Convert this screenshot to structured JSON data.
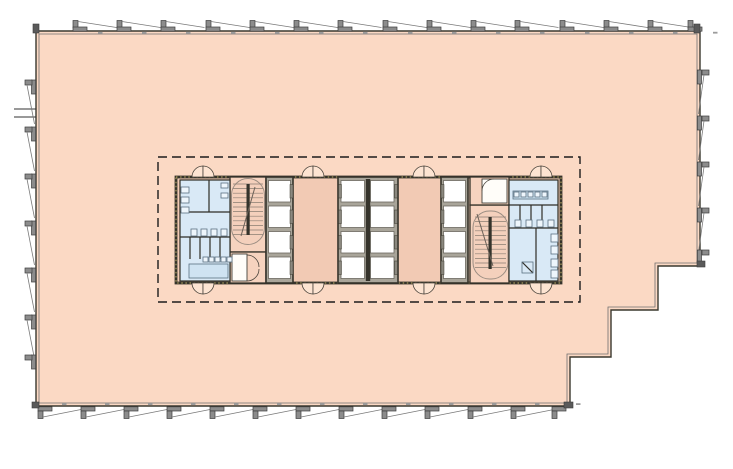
{
  "page": {
    "title": "Office floor plan",
    "background": "#ffffff"
  },
  "watermark": {
    "text_line1": "OFFICE",
    "text_line2": "NAVIGATOR",
    "color": "#ffffff",
    "opacity": 0.55,
    "font_size": 26,
    "letter_spacing": 3.5,
    "blocks": [
      {
        "lines": [
          {
            "text": "OFFICE",
            "x": 50,
            "y": 120
          },
          {
            "text": "NAVIGATOR",
            "x": 50,
            "y": 152
          }
        ]
      },
      {
        "lines": [
          {
            "text": "OFFICE",
            "x": 281,
            "y": 233
          },
          {
            "text": "NAVIGATOR",
            "x": 256,
            "y": 260
          }
        ]
      },
      {
        "lines": [
          {
            "text": "OFFICE",
            "x": 507,
            "y": 342
          },
          {
            "text": "NAVIGATOR",
            "x": 507,
            "y": 370
          }
        ]
      }
    ]
  },
  "colors": {
    "floor": "#fbd9c4",
    "core_base": "#f2cab4",
    "stair_fill": "#f6d3bf",
    "oval_fill": "#f4d0bc",
    "washroom": "#d9e9f6",
    "fixture_fill": "#cfe3f2",
    "fixture_stroke": "#5b7181",
    "wall_dark": "#35332b",
    "wall_speckle": "#c4b269",
    "outline": "#3a382f",
    "inner_line": "#6f6f6f",
    "facade_fill": "#8c8c8c",
    "facade_stroke": "#3c3c3c",
    "shaft_bg": "#a9a59a",
    "cab_fill": "#ffffff",
    "cab_stroke": "#6b685f",
    "door_fill": "#fde4d2",
    "door_stroke": "#4a443c",
    "column_fill": "#35332a",
    "column_dot": "#d2bd4e",
    "dashed_zone": "#1c1c1c",
    "tread": "#8a7d72",
    "access": "#a18e7e"
  },
  "plan": {
    "outline_pts": "36,31 700,31 700,266 658,266 658,310 611,310 611,357 570,357 570,406 36,406",
    "inner_pts": "39,34 697,34 697,263 655,263 655,307 608,307 608,354 567,354 567,403 39,403",
    "left_detail_lines": [
      [
        14,
        109,
        36,
        109
      ],
      [
        14,
        117,
        36,
        117
      ]
    ],
    "dashed_zone": {
      "x": 158,
      "y": 157,
      "w": 422,
      "h": 145
    },
    "facade": {
      "top": {
        "xs": [
          73,
          117,
          161,
          206,
          250,
          294,
          338,
          383,
          427,
          471,
          515,
          560,
          604,
          648,
          688
        ]
      },
      "bottom": {
        "xs": [
          38,
          81,
          124,
          167,
          210,
          253,
          296,
          339,
          382,
          425,
          468,
          511,
          552
        ]
      },
      "right": {
        "ys": [
          70,
          116,
          162,
          208,
          250
        ]
      },
      "left": {
        "ys": [
          80,
          127,
          174,
          221,
          268,
          315,
          355
        ]
      },
      "corners": [
        [
          33,
          24,
          6,
          9
        ],
        [
          694,
          24,
          6,
          9
        ],
        [
          697,
          261,
          8,
          6
        ],
        [
          564,
          402,
          9,
          6
        ],
        [
          32,
          402,
          7,
          6
        ]
      ]
    },
    "columns": [
      [
        123,
        128
      ],
      [
        215,
        128
      ],
      [
        302,
        128
      ],
      [
        390,
        128
      ],
      [
        435,
        128
      ],
      [
        523,
        128
      ],
      [
        612,
        128
      ],
      [
        124,
        219
      ],
      [
        612,
        220
      ],
      [
        125,
        313
      ],
      [
        215,
        313
      ],
      [
        302,
        313
      ],
      [
        390,
        313
      ],
      [
        435,
        313
      ],
      [
        523,
        313
      ],
      [
        523,
        355
      ],
      [
        657,
        266
      ],
      [
        657,
        309
      ],
      [
        611,
        309
      ],
      [
        611,
        356
      ]
    ],
    "core": {
      "base": [
        176,
        177,
        385,
        106
      ],
      "doors": {
        "r": 11,
        "top_y": 177,
        "bottom_y": 283,
        "cx": [
          203,
          313,
          424,
          541
        ]
      },
      "banks": {
        "rows": [
          180.5,
          206,
          231.5,
          257
        ],
        "cab_h": 21.5,
        "door_w": 3,
        "door_h": 13.5,
        "door_dy": 4,
        "items": [
          {
            "bg": [
              266,
              177,
              27,
              106
            ],
            "cab_x": [
              268.5
            ],
            "cab_w": 22,
            "door_x": [
              290
            ]
          },
          {
            "bg": [
              338,
              177,
              60,
              106
            ],
            "cab_x": [
              341,
              370.5
            ],
            "cab_w": 23.5,
            "door_x": [
              338.5,
              394.5
            ],
            "wall": [
              365.8,
              179,
              4.4,
              102
            ]
          },
          {
            "bg": [
              441,
              177,
              27,
              106
            ],
            "cab_x": [
              443.5
            ],
            "cab_w": 22,
            "door_x": [
              441
            ]
          }
        ]
      },
      "stairs": [
        {
          "shaft": [
            230,
            177,
            36,
            75
          ],
          "annex": [
            230,
            252,
            36,
            31
          ],
          "room": [
            232,
            254,
            15,
            27
          ],
          "oval": [
            231.5,
            178.5,
            33,
            66
          ],
          "tread_x": [
            233,
            263
          ],
          "tread_y0": 184,
          "tread_n": 12,
          "tread_step": 4.6,
          "bar": [
            246.5,
            184,
            3.2,
            51
          ],
          "arrow": [
            255,
            187,
            241,
            236
          ],
          "arcs": [
            "M247,255 A12,12 0 0 1 259,267",
            "M247,281 A12,12 0 0 0 259,269"
          ]
        },
        {
          "shaft": [
            470,
            205,
            39,
            78
          ],
          "annex": [
            470,
            177,
            39,
            28
          ],
          "room": [
            482,
            179,
            25,
            24
          ],
          "oval": [
            473,
            211,
            35,
            68
          ],
          "tread_x": [
            475,
            506
          ],
          "tread_y0": 217,
          "tread_n": 12,
          "tread_step": 4.6,
          "bar": [
            488.5,
            217,
            3.2,
            52
          ],
          "arrow": [
            477,
            214,
            493,
            266
          ],
          "arcs": [
            "M482,191 A12,12 0 0 1 494,179"
          ]
        }
      ],
      "washrooms": [
        {
          "area": [
            180,
            180,
            50,
            101
          ],
          "lines": [
            [
              180,
              212,
              230,
              212
            ],
            [
              209,
              180,
              209,
              212
            ],
            [
              180,
              237,
              230,
              237
            ],
            [
              190,
              237,
              190,
              259
            ],
            [
              200,
              237,
              200,
              259
            ],
            [
              210,
              237,
              210,
              259
            ],
            [
              220,
              237,
              220,
              259
            ]
          ],
          "fixtures": [
            {
              "r": [
                189,
                264,
                39,
                14
              ],
              "f": "#cfe3f2"
            },
            {
              "r": [
                181,
                187,
                8,
                6
              ]
            },
            {
              "r": [
                181,
                197,
                8,
                6
              ]
            },
            {
              "r": [
                181,
                207,
                8,
                6
              ]
            },
            {
              "r": [
                191,
                229,
                6,
                7
              ]
            },
            {
              "r": [
                201,
                229,
                6,
                7
              ]
            },
            {
              "r": [
                211,
                229,
                6,
                7
              ]
            },
            {
              "r": [
                221,
                229,
                6,
                7
              ]
            },
            {
              "r": [
                221,
                183,
                7,
                5
              ]
            },
            {
              "r": [
                221,
                193,
                7,
                5
              ]
            },
            {
              "r": [
                203,
                257,
                5,
                5
              ]
            },
            {
              "r": [
                209,
                257,
                5,
                5
              ]
            },
            {
              "r": [
                215,
                257,
                5,
                5
              ]
            },
            {
              "r": [
                221,
                257,
                5,
                5
              ]
            },
            {
              "r": [
                227,
                257,
                5,
                5
              ]
            }
          ]
        },
        {
          "area": [
            509,
            180,
            49,
            101
          ],
          "lines": [
            [
              509,
              205,
              558,
              205
            ],
            [
              509,
              228,
              558,
              228
            ],
            [
              536,
              228,
              536,
              281
            ],
            [
              520,
              205,
              520,
              227
            ],
            [
              531,
              205,
              531,
              227
            ],
            [
              542,
              205,
              542,
              227
            ],
            [
              522,
              262,
              533,
              273
            ]
          ],
          "fixtures": [
            {
              "r": [
                513,
                191,
                35,
                8
              ],
              "f": "#cfe3f2"
            },
            {
              "r": [
                514,
                192,
                5,
                5
              ]
            },
            {
              "r": [
                521,
                192,
                5,
                5
              ]
            },
            {
              "r": [
                528,
                192,
                5,
                5
              ]
            },
            {
              "r": [
                535,
                192,
                5,
                5
              ]
            },
            {
              "r": [
                542,
                192,
                5,
                5
              ]
            },
            {
              "r": [
                515,
                220,
                6,
                7
              ]
            },
            {
              "r": [
                526,
                220,
                6,
                7
              ]
            },
            {
              "r": [
                537,
                220,
                6,
                7
              ]
            },
            {
              "r": [
                548,
                220,
                6,
                7
              ]
            },
            {
              "r": [
                551,
                234,
                7,
                8
              ]
            },
            {
              "r": [
                551,
                246,
                7,
                8
              ]
            },
            {
              "r": [
                551,
                259,
                7,
                8
              ]
            },
            {
              "r": [
                551,
                270,
                7,
                8
              ]
            },
            {
              "r": [
                522,
                262,
                11,
                11
              ],
              "f": "none"
            }
          ]
        }
      ],
      "accessible": {
        "symbol": "♿",
        "size": 15,
        "points": [
          [
            306,
            251
          ],
          [
            412,
            251
          ]
        ]
      }
    }
  }
}
